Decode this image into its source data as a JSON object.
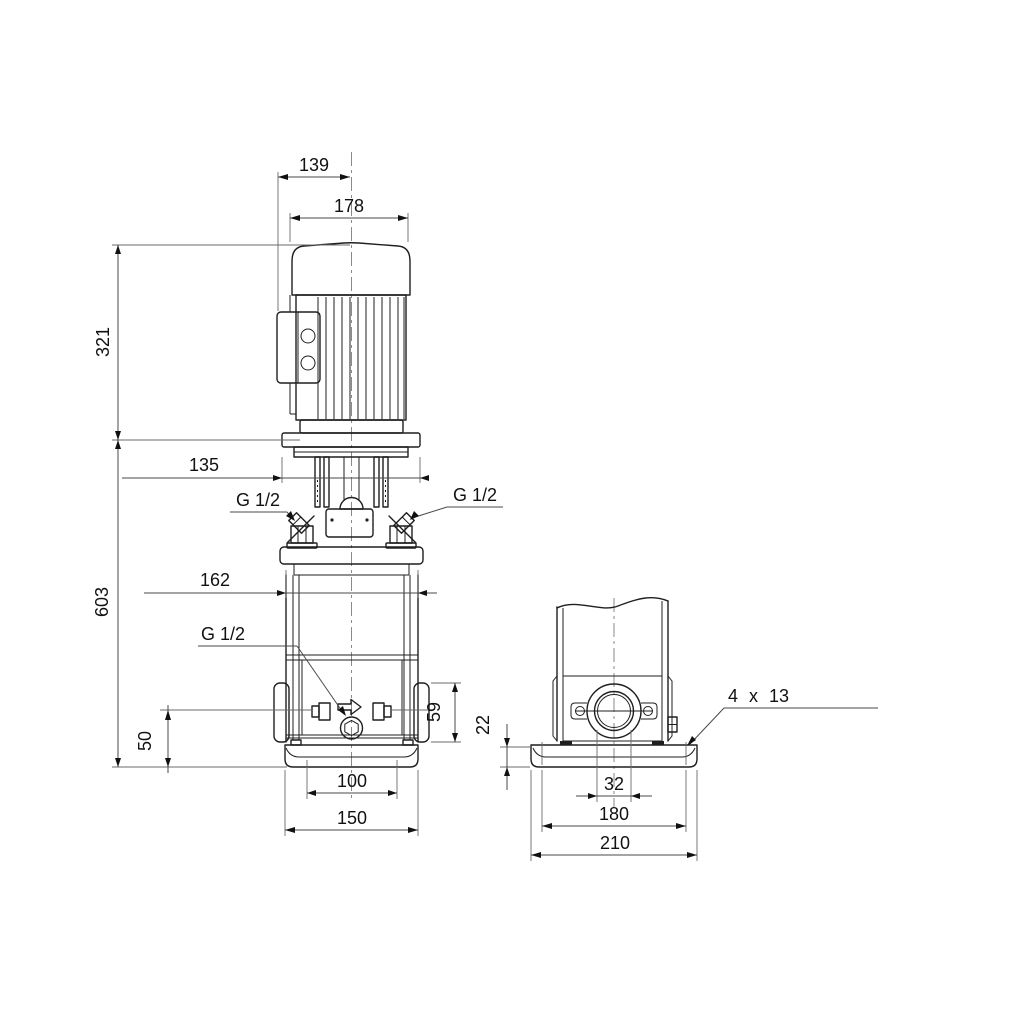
{
  "drawing": {
    "background": "#ffffff",
    "outline_color": "#1f1f1f",
    "dimension_color": "#4a4a4a",
    "text_color": "#111111"
  },
  "front_view": {
    "dim_terminal_box_to_center": "139",
    "dim_motor_width": "178",
    "dim_motor_height": "321",
    "dim_flange_width": "135",
    "port_plug_left": "G 1/2",
    "port_plug_right": "G 1/2",
    "dim_sleeve_width": "162",
    "drain_plug": "G 1/2",
    "dim_total_height": "603",
    "dim_port_height": "50",
    "dim_port_flange_height": "59",
    "dim_foot_inner_width": "100",
    "dim_foot_width": "150"
  },
  "side_view": {
    "dim_base_thickness": "22",
    "dim_port_bore": "32",
    "dim_bolt_spacing": "180",
    "dim_base_width": "210",
    "bolt_holes": "4 x 13"
  }
}
